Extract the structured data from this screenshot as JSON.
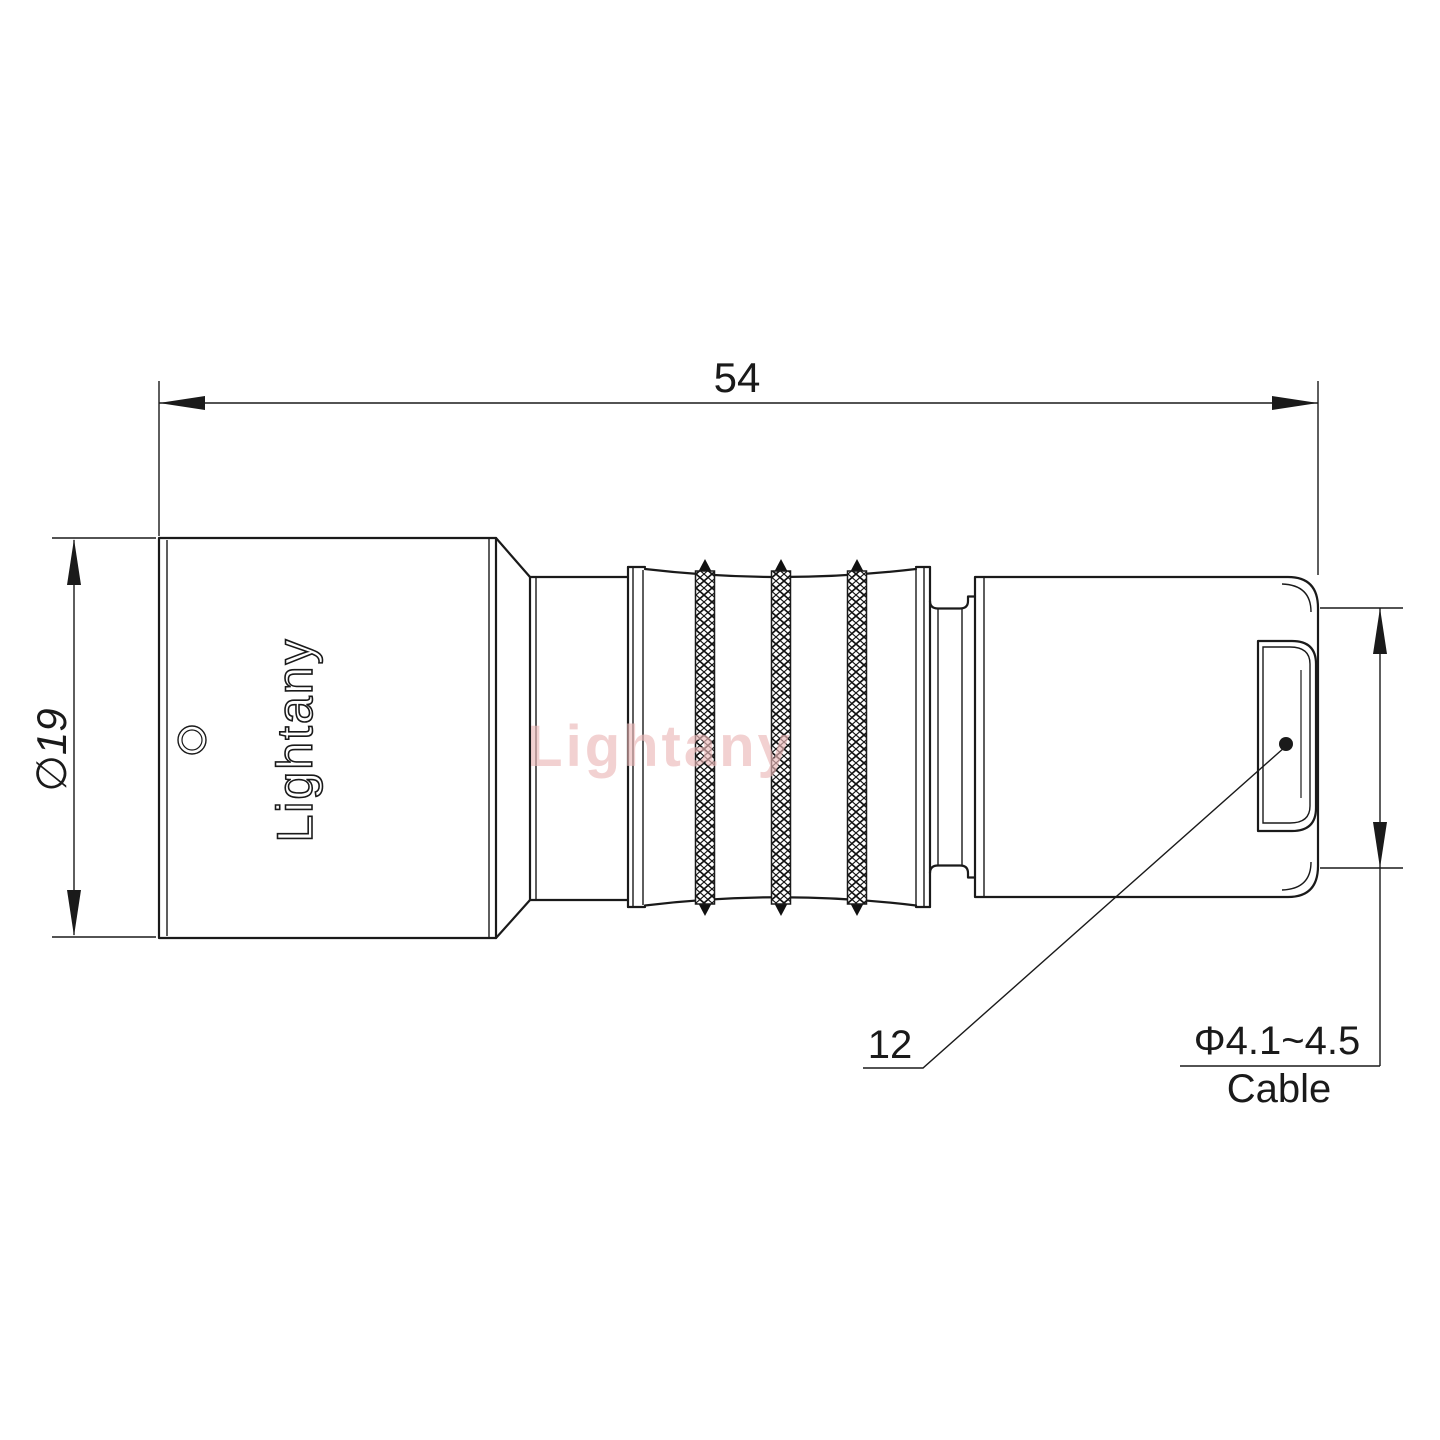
{
  "drawing": {
    "labels": {
      "overall_length": "54",
      "body_diameter": "∅19",
      "rear_length": "12",
      "cable_diameter": "Φ4.1~4.5",
      "cable_word": "Cable"
    },
    "branding": {
      "engraved_logo": "Lightany",
      "watermark": "Lightany"
    },
    "colors": {
      "line": "#1a1a1a",
      "watermark": "#ecb9b9",
      "background": "#ffffff"
    }
  }
}
